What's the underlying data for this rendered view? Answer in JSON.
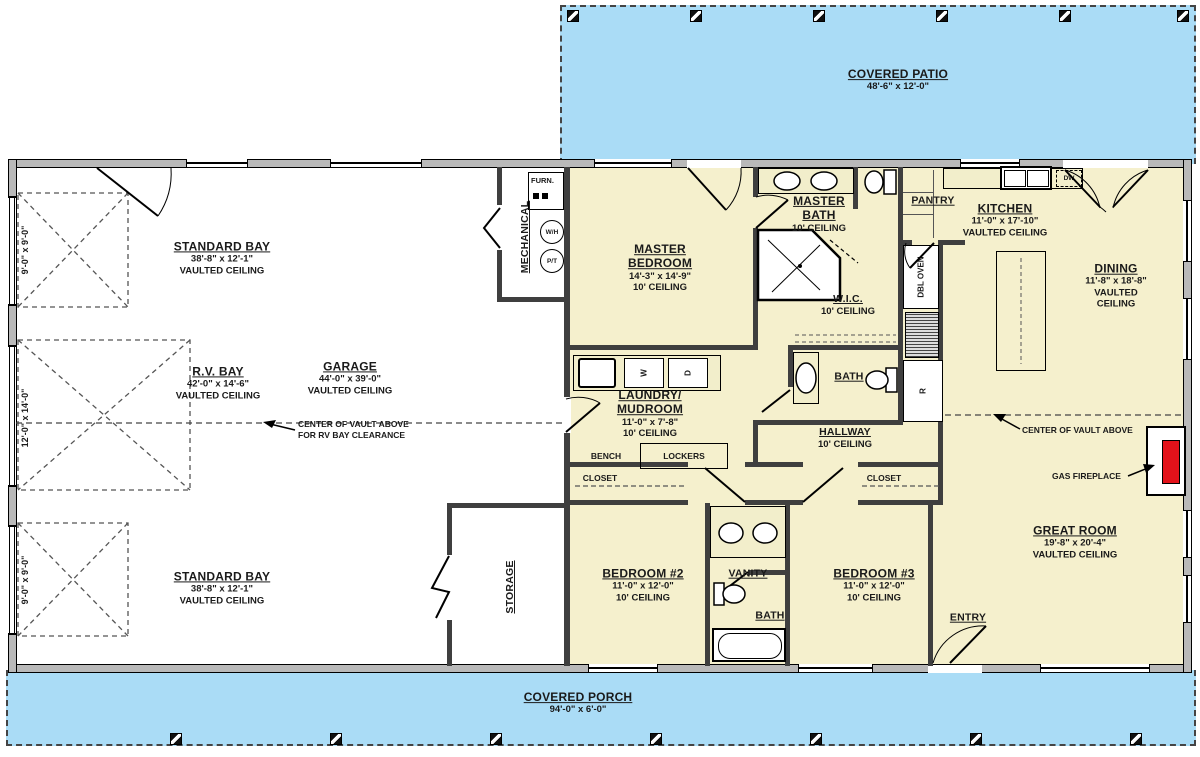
{
  "outdoor": {
    "covered_patio": {
      "name": "COVERED PATIO",
      "dims": "48'-6\" x 12'-0\""
    },
    "covered_porch": {
      "name": "COVERED PORCH",
      "dims": "94'-0\" x 6'-0\""
    }
  },
  "garage": {
    "standard_bay_top": {
      "name": "STANDARD BAY",
      "dims": "38'-8\" x 12'-1\"",
      "ceiling": "VAULTED CEILING"
    },
    "rv_bay": {
      "name": "R.V. BAY",
      "dims": "42'-0\" x 14'-6\"",
      "ceiling": "VAULTED CEILING"
    },
    "garage_room": {
      "name": "GARAGE",
      "dims": "44'-0\" x 39'-0\"",
      "ceiling": "VAULTED CEILING"
    },
    "standard_bay_bottom": {
      "name": "STANDARD BAY",
      "dims": "38'-8\" x 12'-1\"",
      "ceiling": "VAULTED CEILING"
    },
    "mechanical": {
      "name": "MECHANICAL"
    },
    "storage": {
      "name": "STORAGE"
    },
    "door_dim_top": "9'-0\" x 9'-0\"",
    "door_dim_rv": "12'-0\" x 14'-0\"",
    "door_dim_bottom": "9'-0\" x 9'-0\""
  },
  "rooms": {
    "master_bedroom": {
      "name": "MASTER BEDROOM",
      "dims": "14'-3\" x 14'-9\"",
      "ceiling": "10' CEILING"
    },
    "master_bath": {
      "name": "MASTER BATH",
      "ceiling": "10' CEILING"
    },
    "wic": {
      "name": "W.I.C.",
      "ceiling": "10' CEILING"
    },
    "pantry": {
      "name": "PANTRY"
    },
    "kitchen": {
      "name": "KITCHEN",
      "dims": "11'-0\" x 17'-10\"",
      "ceiling": "VAULTED CEILING"
    },
    "dining": {
      "name": "DINING",
      "dims": "11'-8\" x 18'-8\"",
      "ceiling": "VAULTED CEILING"
    },
    "laundry": {
      "name": "LAUNDRY/ MUDROOM",
      "dims": "11'-0\" x 7'-8\"",
      "ceiling": "10' CEILING"
    },
    "bath_hall": {
      "name": "BATH"
    },
    "hallway": {
      "name": "HALLWAY",
      "ceiling": "10' CEILING"
    },
    "bedroom2": {
      "name": "BEDROOM #2",
      "dims": "11'-0\" x 12'-0\"",
      "ceiling": "10' CEILING"
    },
    "bedroom3": {
      "name": "BEDROOM #3",
      "dims": "11'-0\" x 12'-0\"",
      "ceiling": "10' CEILING"
    },
    "vanity": {
      "name": "VANITY"
    },
    "bath2": {
      "name": "BATH"
    },
    "great_room": {
      "name": "GREAT ROOM",
      "dims": "19'-8\" x 20'-4\"",
      "ceiling": "VAULTED CEILING"
    },
    "entry": {
      "name": "ENTRY"
    },
    "closet_left": {
      "name": "CLOSET"
    },
    "closet_right": {
      "name": "CLOSET"
    }
  },
  "annotations": {
    "garage_vault_line1": "CENTER OF VAULT ABOVE",
    "garage_vault_line2": "FOR RV BAY CLEARANCE",
    "great_vault": "CENTER OF VAULT ABOVE",
    "gas_fireplace": "GAS FIREPLACE"
  },
  "fixtures": {
    "furnace": "FURN.",
    "water_heater": "W/H",
    "pressure_tank": "P/T",
    "dbl_oven": "DBL OVEN",
    "fridge": "R",
    "dishwasher": "DW",
    "washer": "W",
    "dryer": "D",
    "bench": "BENCH",
    "lockers": "LOCKERS"
  },
  "colors": {
    "outdoor_blue": "#aadcf6",
    "living_cream": "#f5f0cd",
    "fireplace_red": "#e3121a"
  }
}
